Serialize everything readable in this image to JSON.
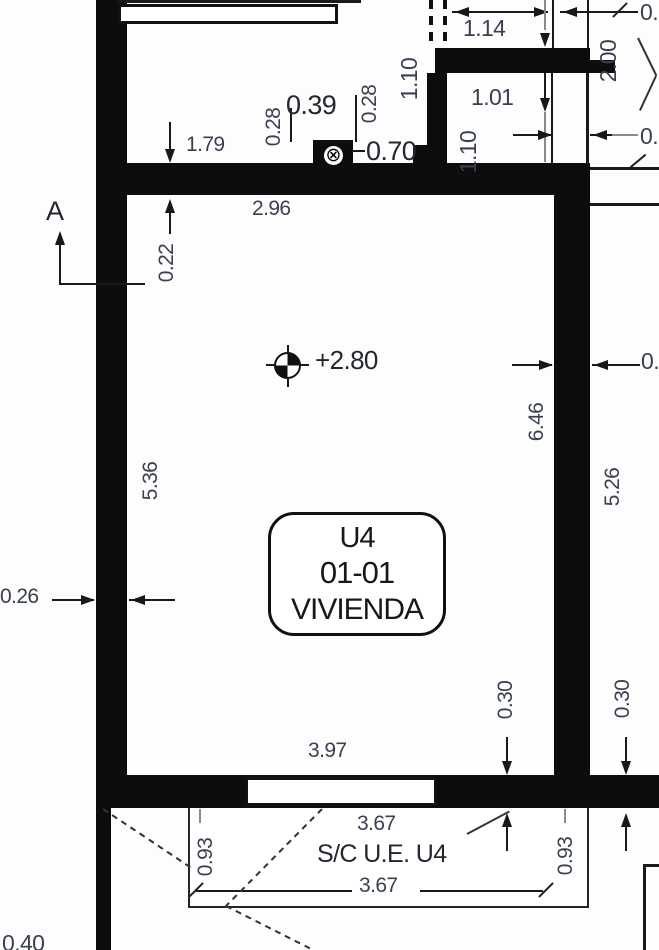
{
  "title": "Floor plan detail — unit U4 01-01 VIVIENDA",
  "colors": {
    "wall": "#0d0d0d",
    "dim_text": "#394150",
    "line": "#1a1a1a",
    "background": "#ffffff"
  },
  "markers": {
    "section_label": "A",
    "level_value": "+2.80",
    "column_symbol_glyph": "⊗"
  },
  "room_label": {
    "unit": "U4",
    "code": "01-01",
    "use": "VIVIENDA"
  },
  "area_below": {
    "top_dim": "3.67",
    "name": "S/C U.E. U4",
    "bottom_dim": "3.67"
  },
  "dims": {
    "d179": "1.79",
    "d028a": "0.28",
    "d039": "0.39",
    "d028b": "0.28",
    "d070": "0.70",
    "d114": "1.14",
    "d110a": "1.10",
    "d101": "1.01",
    "d110b": "1.10",
    "d200": "2.00",
    "d296": "2.96",
    "d022": "0.22",
    "d536": "5.36",
    "d646": "6.46",
    "d526": "5.26",
    "d026": "0.26",
    "d030a": "0.30",
    "d030b": "0.30",
    "d397": "3.97",
    "d093a": "0.93",
    "d093b": "0.93",
    "cut_top_right": "0.",
    "cut_mid_right": "0.",
    "cut_wall_right": "0.",
    "cut_bottom_left": "0.40"
  }
}
